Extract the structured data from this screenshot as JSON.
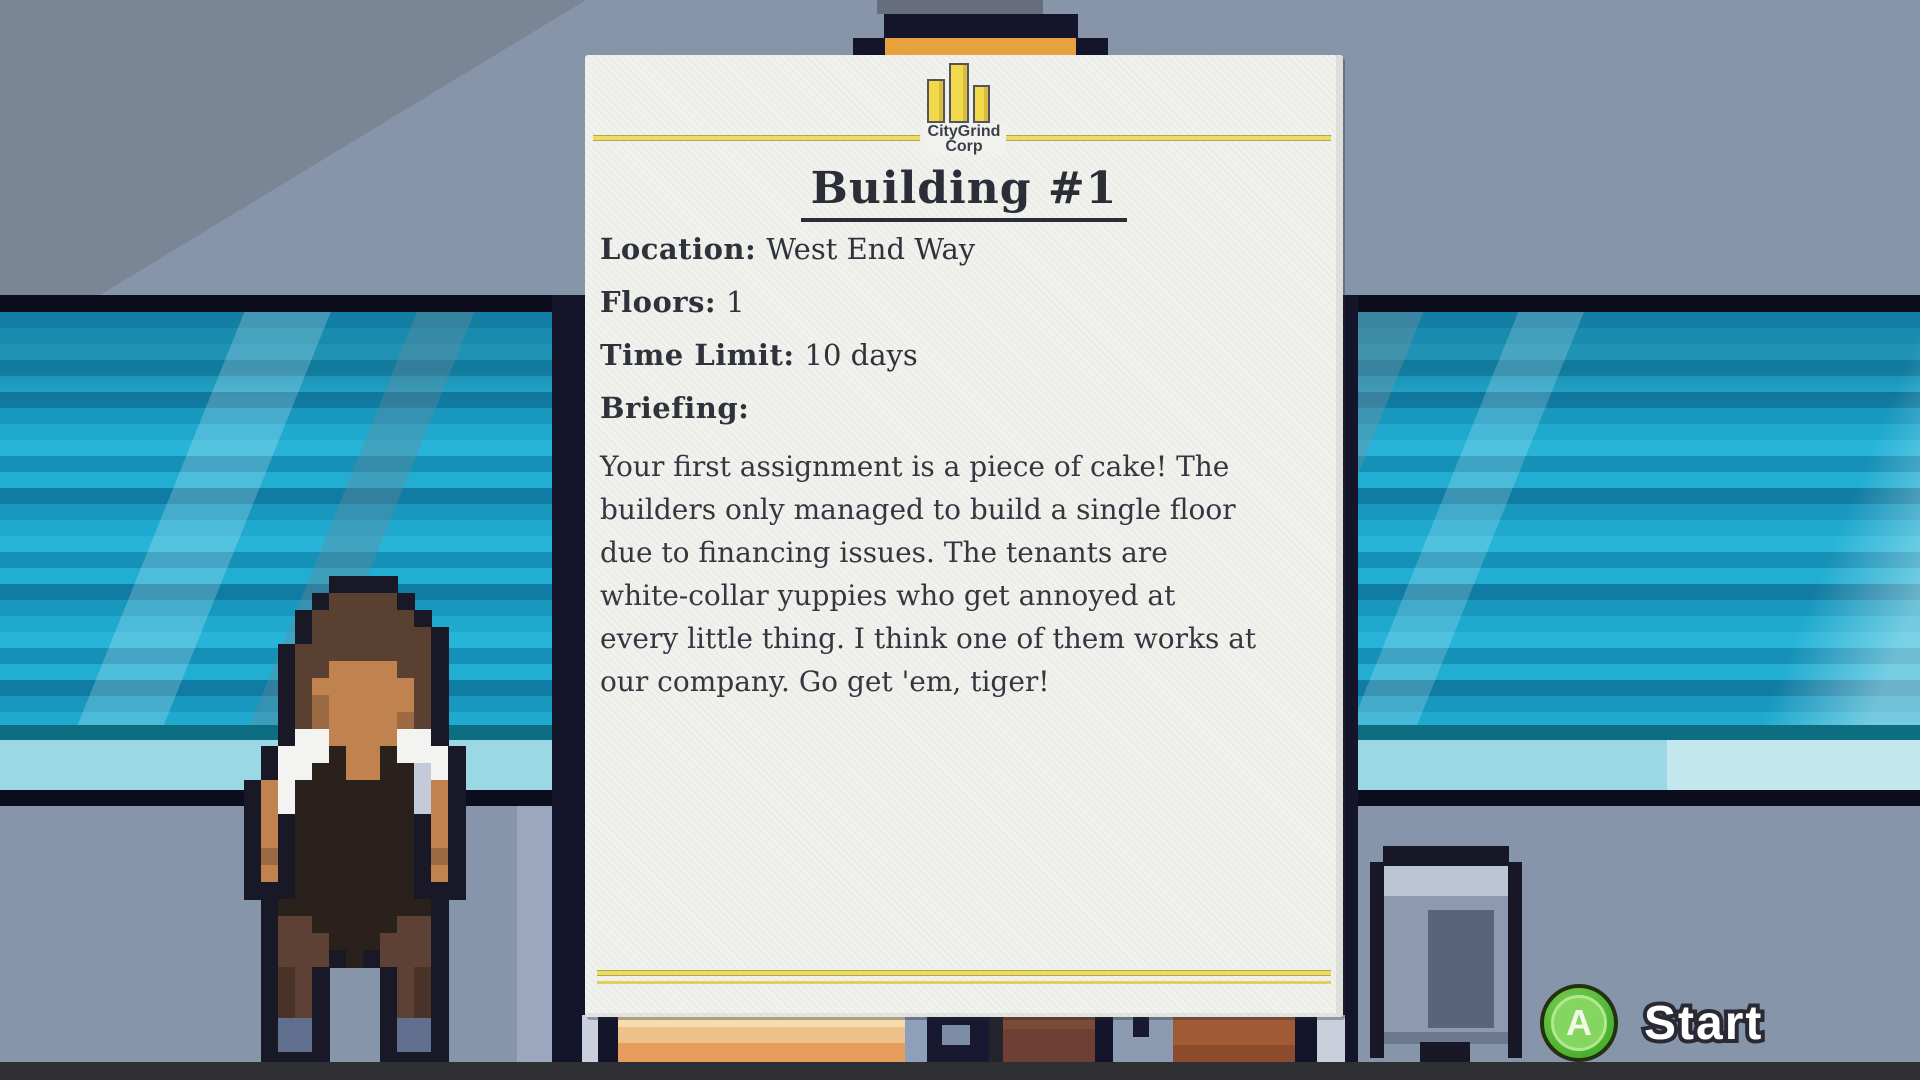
{
  "briefing_card": {
    "company_name_line1": "CityGrind",
    "company_name_line2": "Corp",
    "title": "Building #1",
    "fields": [
      {
        "label": "Location:",
        "value": "West End Way"
      },
      {
        "label": "Floors:",
        "value": "1"
      },
      {
        "label": "Time Limit:",
        "value": "10 days"
      }
    ],
    "briefing_label": "Briefing:",
    "briefing_lines": [
      "Your first assignment is a piece of cake! The",
      "builders only managed to build a single floor",
      "due to financing issues. The tenants are",
      "white-collar yuppies who get annoyed at",
      "every little thing. I think one of them works at",
      "our company. Go get 'em, tiger!"
    ]
  },
  "start_prompt": {
    "button_letter": "A",
    "label": "Start"
  },
  "colors": {
    "wall": "#8795ab",
    "wall_shadow": "#7a8696",
    "window_frame": "#0d0e1d",
    "window_glass": "#1fa9ce",
    "paper": "#f1f2ee",
    "accent_line_yellow": "#ecdc63",
    "logo_yellow": "#f2d94b",
    "clip_orange": "#e7a23d",
    "text_dark": "#2f323b",
    "start_green": "#5ec13e",
    "floor": "#2e3034"
  },
  "pixel_art": {
    "character": {
      "unit": 17,
      "palette": {
        "O": "#181826",
        "H": "#5a4030",
        "S": "#c0824f",
        "s": "#9c6a42",
        "W": "#f3f4f1",
        "w": "#c3cbd8",
        "N": "#2b211c",
        "B": "#5d4134",
        "b": "#4a3329",
        "G": "#5f6f8d"
      },
      "rows": [
        ".....OOOO....",
        "....OHHHHO...",
        "...OHHHHHHO..",
        "...OHHHHHHHO.",
        "..OHHHHHHHHO.",
        "..OHHSSSSHHO.",
        "..OHSSSSSSHO.",
        "..OHsSSSSSHO.",
        "..OHsSSSSsHO.",
        "..OWWSSSSWWO.",
        ".OWWWNSSNWWWO",
        ".OWWNNSSNNwWO",
        "OSWNNNNNNNwSO",
        "OSWNNNNNNNwSO",
        "OSONNNNNNNOSO",
        "OSONNNNNNNOSO",
        "OsONNNNNNNOsO",
        "OSONNNNNNNOSO",
        "OOONNNNNNNOOO",
        ".ONNNNNNNNNO.",
        ".OBBNNNNNBBO.",
        ".OBBBNNNBBBO.",
        ".OBBBONOBBBO.",
        ".ObBO...OBbO.",
        ".ObBO...OBbO.",
        ".ObBO...OBbO.",
        ".OGGO...OGGO.",
        ".OGGO...OGGO.",
        ".OOOO...OOOO."
      ]
    }
  }
}
